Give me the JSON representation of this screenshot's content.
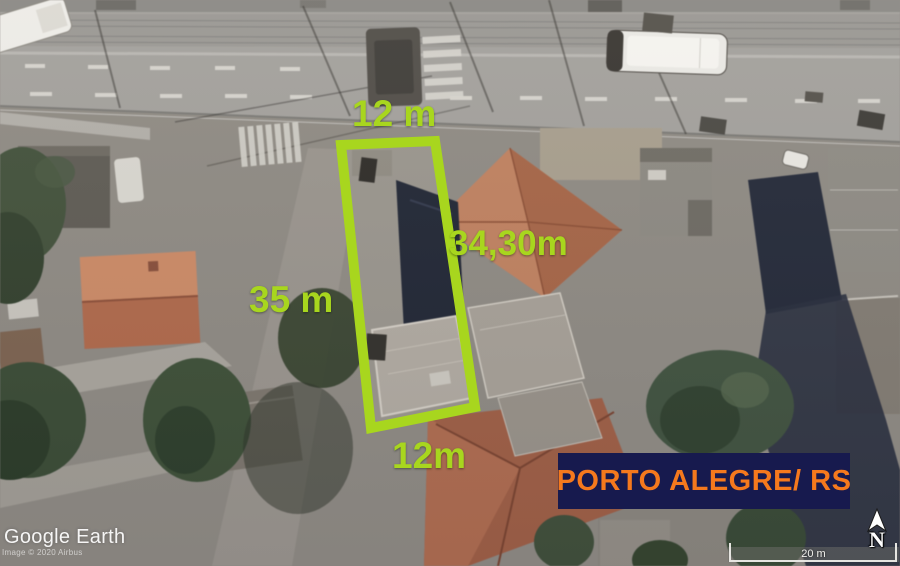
{
  "app": {
    "name": "Google Earth"
  },
  "colors": {
    "annotation-green": "#A8D61E",
    "banner-bg": "#171A4E",
    "banner-text": "#F5791D"
  },
  "annotations": {
    "top_width": "12 m",
    "right_length": "34,30m",
    "left_length": "35 m",
    "bottom_width": "12m",
    "location_banner": "PORTO ALEGRE/ RS"
  },
  "watermark": {
    "logo": "Google Earth",
    "attribution": "Image © 2020 Airbus"
  },
  "map_controls": {
    "north_label": "N",
    "scale_label": "20 m"
  }
}
